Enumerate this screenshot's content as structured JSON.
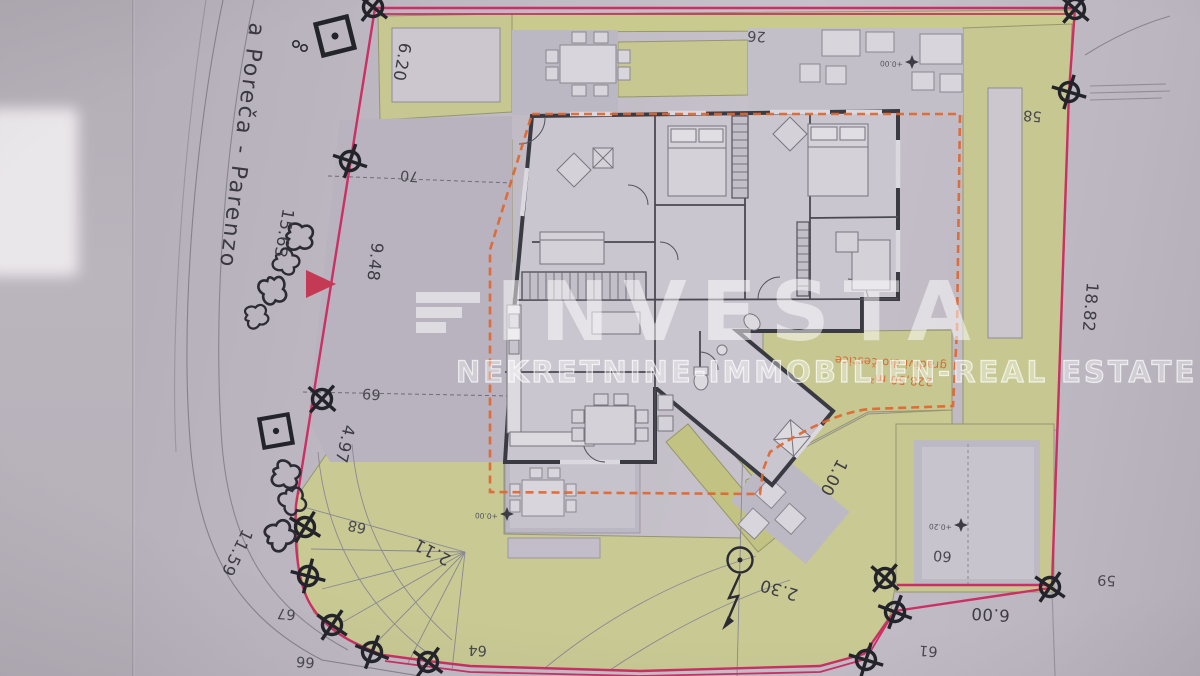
{
  "document": {
    "kind": "cadastral site plan photo"
  },
  "labels": {
    "road_name": "a Poreča - Parenzo",
    "dim_top_left": "6.20",
    "dim_road_upper": "15.63",
    "dim_left_mid": "9.48",
    "dim_left_lower": "4.97",
    "dim_road_lower": "11.59",
    "dim_bottom_left": "2.11",
    "dim_bottom_mid": "2.30",
    "dim_path": "1.00",
    "dim_bottom_right": "6.00",
    "dim_right": "18.82"
  },
  "points": {
    "p26": "26",
    "p58": "58",
    "p59": "59",
    "p60": "60",
    "p61": "61",
    "p64": "64",
    "p66": "66",
    "p67": "67",
    "p68": "68",
    "p69": "69",
    "p70": "70"
  },
  "area_note": {
    "line1": "gradivi dio čestice",
    "line2": "228,50 m²"
  },
  "elevations": {
    "main": "+0.00",
    "terrace": "+0.00",
    "patio_right": "+0.20"
  },
  "watermark": {
    "brand": "INVESTA",
    "subtitle": "NEKRETNINE-IMMOBILIEN-REAL ESTATE"
  },
  "colors": {
    "boundary_pink": "#cb2f63",
    "buildable_orange": "#e0662f",
    "lawn_green": "#c6c791",
    "paper": "#c0bac4",
    "wall_dark": "#3a3a42",
    "watermark_white": "#ffffff"
  }
}
